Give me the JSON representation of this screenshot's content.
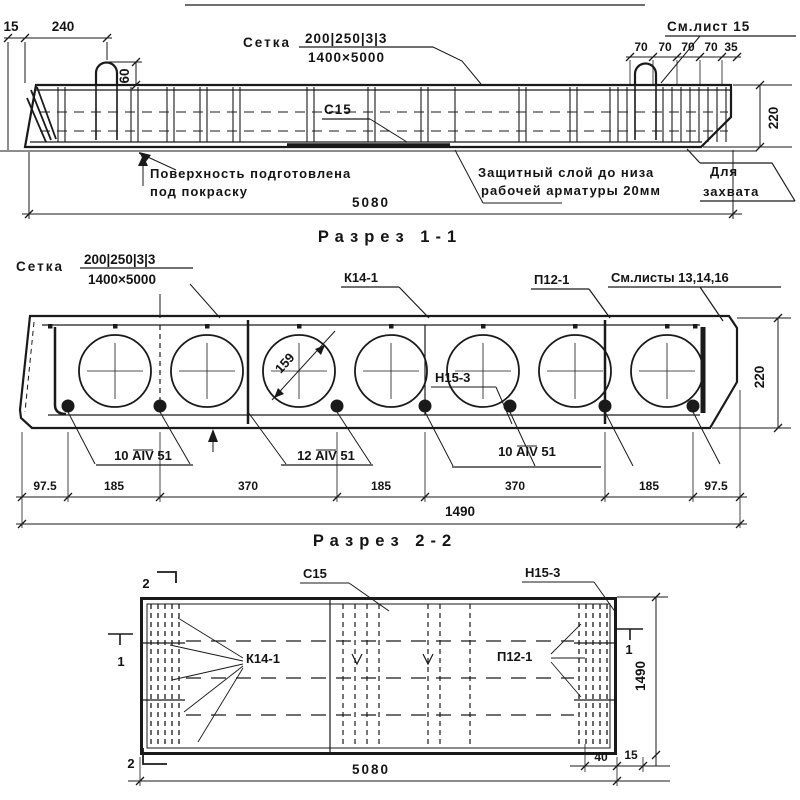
{
  "colors": {
    "ink": "#1a1a1a",
    "paper": "#ffffff"
  },
  "elevation": {
    "dim_edge": "15",
    "dim_loop": "240",
    "dim_loop_height": "60",
    "mesh": {
      "label": "Сетка",
      "top": "200|250|3|3",
      "bottom": "1400×5000"
    },
    "see_sheet": "См.лист 15",
    "end_dims": [
      "70",
      "70",
      "70",
      "70",
      "35"
    ],
    "dim_height": "220",
    "plate": "С15",
    "surface_note": [
      "Поверхность подготовлена",
      "под покраску"
    ],
    "cover_note": [
      "Защитный слой до низа",
      "рабочей арматуры 20мм"
    ],
    "grip_note": [
      "Для",
      "захвата"
    ],
    "dim_length": "5080"
  },
  "section1": {
    "title": "Разрез 1-1",
    "mesh": {
      "label": "Сетка",
      "top": "200|250|3|3",
      "bottom": "1400×5000"
    },
    "k14": "К14-1",
    "p12": "П12-1",
    "see_sheets": "См.листы 13,14,16",
    "void_dia": "159",
    "h15": "Н15-3",
    "dim_height": "220",
    "rebar": [
      "10 АIV 51",
      "12 АIV 51",
      "10 АIV 51"
    ],
    "chain": [
      "97.5",
      "185",
      "370",
      "185",
      "370",
      "185",
      "97.5"
    ],
    "dim_total": "1490"
  },
  "section2": {
    "title": "Разрез 2-2",
    "c15": "С15",
    "h15": "Н15-3",
    "k14": "К14-1",
    "p12": "П12-1",
    "marker1": "1",
    "marker2": "2",
    "dim_width": "1490",
    "dim_length": "5080",
    "dim_40": "40",
    "dim_15": "15"
  }
}
